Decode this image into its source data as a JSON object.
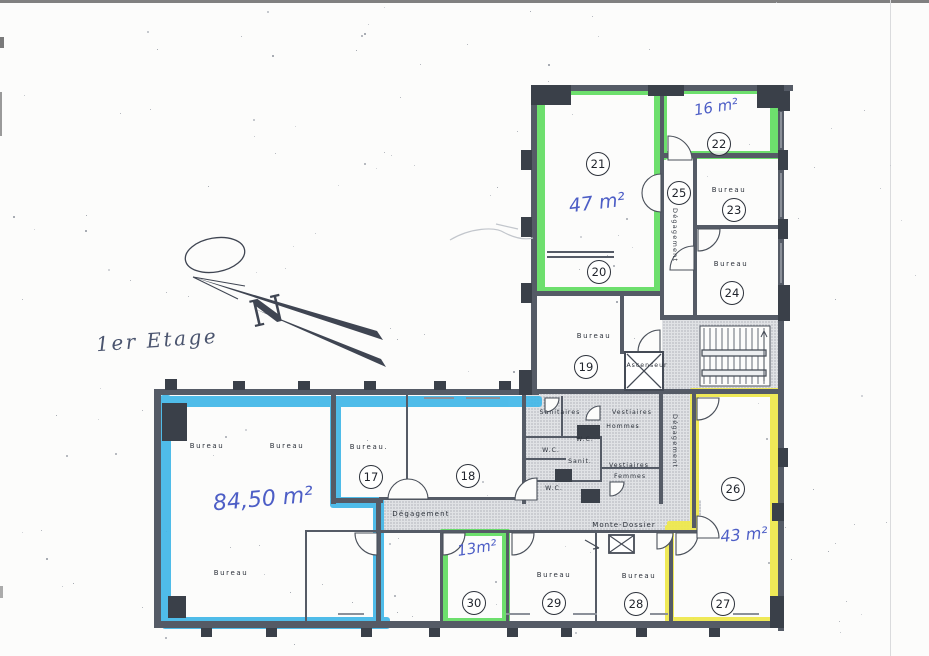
{
  "page": {
    "floor_label": "1er Etage",
    "compass_letter": "N"
  },
  "colors": {
    "marker_blue": "#41b7e8",
    "marker_green": "#5edc5e",
    "marker_yellow": "#efe94f",
    "ink_blue": "#4d5ec6",
    "plan_dark": "#3a4049",
    "wall_gray": "#555b66",
    "hatch_bg": "#e0e2e5"
  },
  "annotations": {
    "room22_area": "16 m²",
    "room21_area": "47 m²",
    "blue_room_area": "84,50 m²",
    "room30_area": "13m²",
    "rooms_26_27_area": "43 m²"
  },
  "labels": {
    "bureau": "Bureau",
    "bureau_dot": "Bureau.",
    "degagement": "Dégagement",
    "monte_dossier": "Monte-Dossier",
    "ascenseur": "Ascenseur",
    "sanitaires": "Sanitaires",
    "vestiaires": "Vestiaires",
    "hommes": "Hommes",
    "femmes": "Femmes",
    "wc": "W.C.",
    "sanit": "Sanit."
  },
  "rooms": [
    {
      "number": "17"
    },
    {
      "number": "18"
    },
    {
      "number": "19"
    },
    {
      "number": "20"
    },
    {
      "number": "21"
    },
    {
      "number": "22"
    },
    {
      "number": "23"
    },
    {
      "number": "24"
    },
    {
      "number": "25"
    },
    {
      "number": "26"
    },
    {
      "number": "27"
    },
    {
      "number": "28"
    },
    {
      "number": "29"
    },
    {
      "number": "30"
    }
  ]
}
